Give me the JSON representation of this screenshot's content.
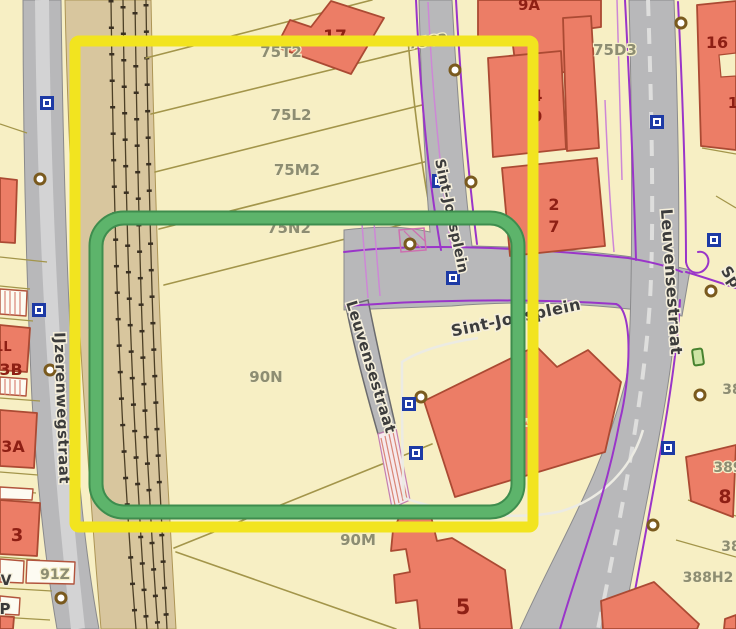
{
  "map_type": "cadastral-parcel-map",
  "streets": {
    "ijzerenwegstraat": "IJzerenwegstraat",
    "sint_jobsplein_v": "Sint-Jobsplein",
    "sint_jobsplein_h": "Sint-Jobsplein",
    "leuvensestraat_mid": "Leuvensestraat",
    "leuvensestraat_right": "Leuvensestraat",
    "street_partial_right": "Sp"
  },
  "parcels": {
    "p75T2": "75T2",
    "p75L2": "75L2",
    "p75M2": "75M2",
    "p75N2": "75N2",
    "p75C3": "75C3",
    "p75D3": "75D3",
    "p90N": "90N",
    "p90M": "90M",
    "p91Z": "91Z",
    "p388H2": "388H2",
    "p389": "389",
    "p38a": "38",
    "p38b": "38"
  },
  "house_numbers": {
    "n17": "17",
    "n9A": "9A",
    "n4": "4",
    "n9": "9",
    "n2": "2",
    "n7": "7",
    "n16": "16",
    "n1": "1",
    "n8": "8",
    "n5": "5",
    "n3": "3",
    "n3A": "3A",
    "n3B": "3B",
    "n1L": "1L",
    "n6A": "6A",
    "nV": "V",
    "nP": "P"
  },
  "markers": {
    "blue_square": "utility-point-marker",
    "brown_circle": "boundary-point-marker",
    "green_rectangle": "small-green-marker"
  },
  "overlays": {
    "yellow_rectangle": "yellow-selection-rectangle",
    "green_rectangle": "green-selection-rectangle"
  },
  "colors": {
    "parcel_fill": "#f7efc4",
    "parcel_line": "#a3954a",
    "building_fill": "#ec7d66",
    "building_line": "#ab4a33",
    "building_number_text": "#8e1f14",
    "road_fill": "#b8b8ba",
    "railway_fill": "#d8c69e",
    "purple_line": "#9a35c9",
    "street_text": "#3c3c3c",
    "parcel_text": "#8d8d72",
    "overlay_yellow": "#f2e41f",
    "overlay_green": "#58ae66",
    "marker_blue": "#1d3aa5",
    "marker_brown": "#7a5a1e"
  }
}
